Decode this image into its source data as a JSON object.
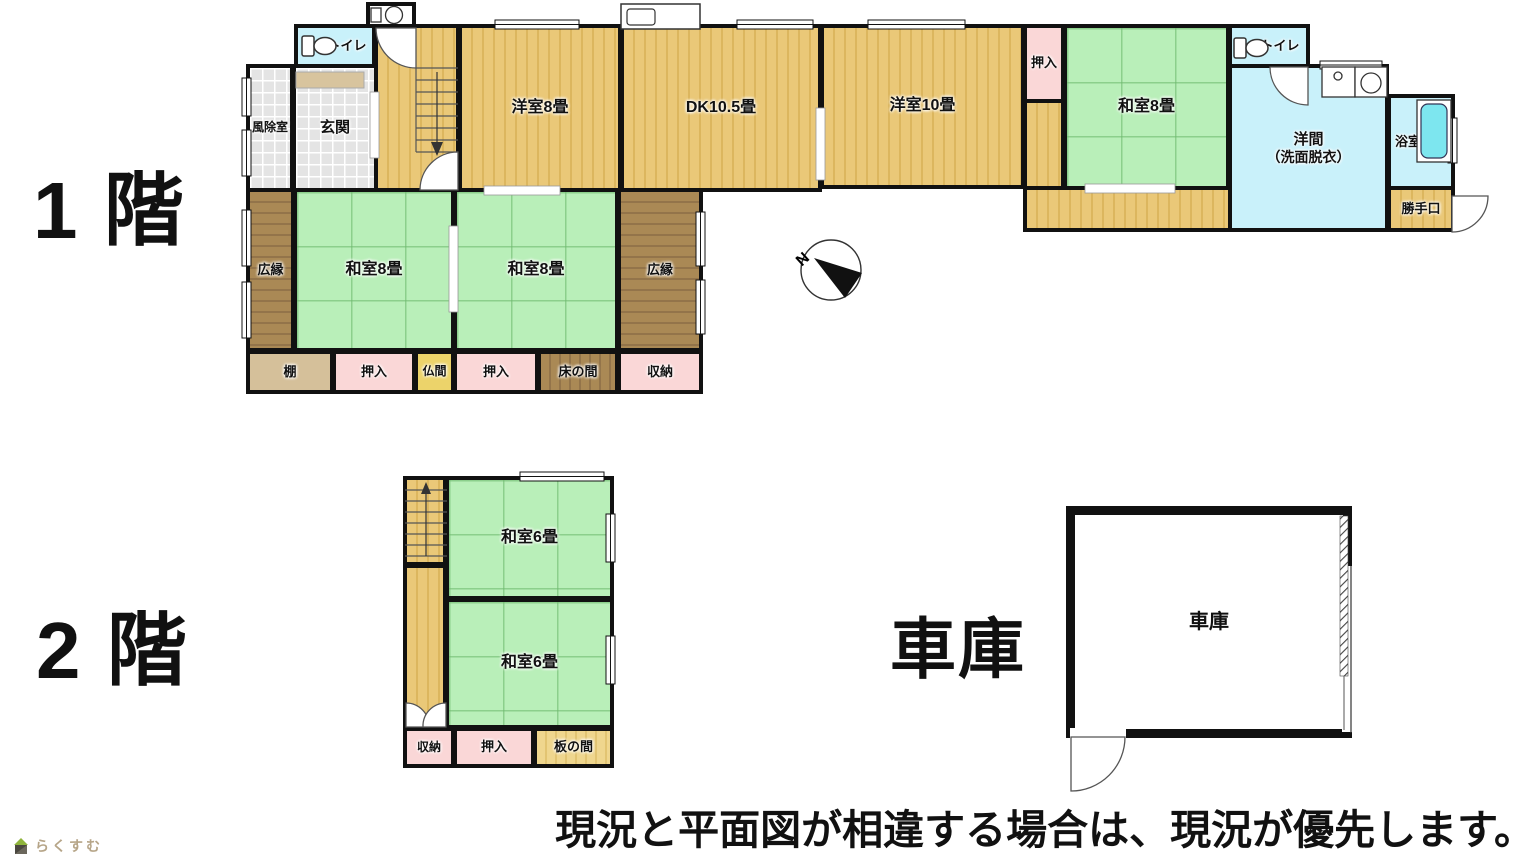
{
  "colors": {
    "wall": "#111111",
    "tatami": "#b9efb9",
    "wood_floor": "#eac878",
    "veranda": "#aa8955",
    "closet_pink": "#fad7d7",
    "water_cyan": "#c9f1fa",
    "butsuma_yellow": "#ecd36a",
    "bathtub": "#7de6ef",
    "logo_text": "#b6a588"
  },
  "floor1": {
    "title": "1 階",
    "rooms": {
      "fujoshitsu": "風除室",
      "genkan": "玄関",
      "toilet_left": "トイレ",
      "yoshitsu8": "洋室8畳",
      "dk": "DK10.5畳",
      "yoshitsu10": "洋室10畳",
      "oshiire_top": "押入",
      "washitsu8_ne": "和室8畳",
      "toilet_right": "トイレ",
      "yoma": "洋間",
      "yoma_sub": "（洗面脱衣）",
      "yokushitsu": "浴室",
      "katteguchi": "勝手口",
      "hiroen_left": "広縁",
      "washitsu8_a": "和室8畳",
      "washitsu8_b": "和室8畳",
      "hiroen_right": "広縁",
      "tana": "棚",
      "oshiire_a": "押入",
      "butsuma": "仏間",
      "oshiire_b": "押入",
      "tokonoma": "床の間",
      "shuno": "収納"
    }
  },
  "floor2": {
    "title": "2 階",
    "rooms": {
      "washitsu6_top": "和室6畳",
      "washitsu6_bottom": "和室6畳",
      "shuno": "収納",
      "oshiire": "押入",
      "itanoma": "板の間"
    }
  },
  "garage": {
    "title": "車庫",
    "label": "車庫"
  },
  "compass": {
    "north": "N"
  },
  "footer": {
    "disclaimer": "現況と平面図が相違する場合は、現況が優先します。",
    "logo": "らくすむ"
  }
}
